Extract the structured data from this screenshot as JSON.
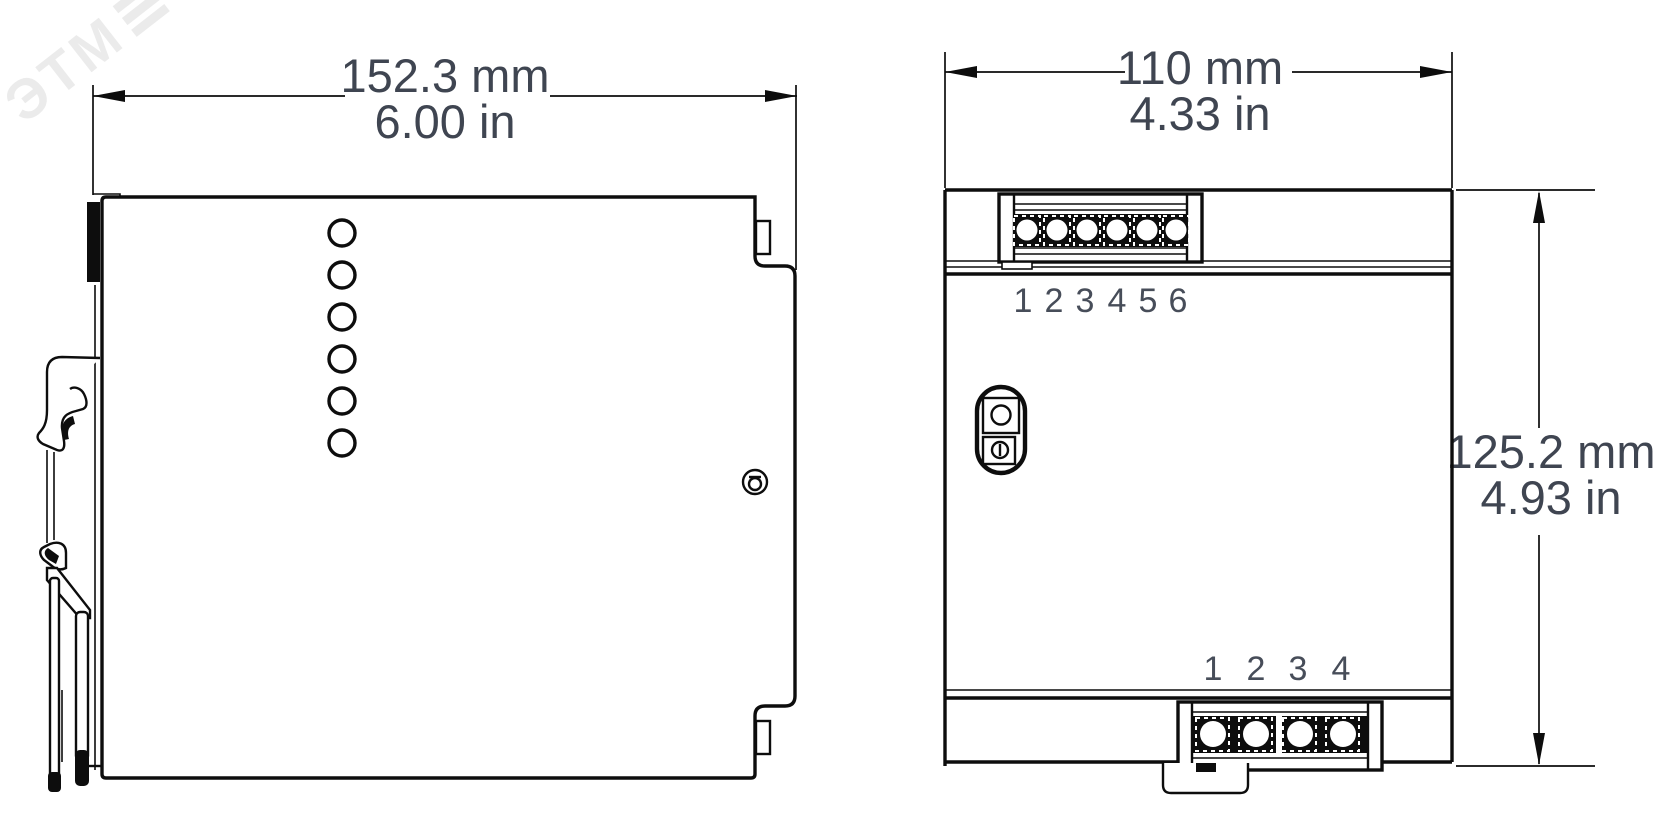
{
  "watermark": {
    "text": "ЭТМ"
  },
  "left_view": {
    "title": "side-view-technical-drawing",
    "width_dimension": {
      "mm": "152.3 mm",
      "in": "6.00 in"
    },
    "vent_hole_count": 6
  },
  "right_view": {
    "title": "front-view-technical-drawing",
    "width_dimension": {
      "mm": "110 mm",
      "in": "4.33 in"
    },
    "height_dimension": {
      "mm": "125.2 mm",
      "in": "4.93 in"
    },
    "top_terminal_labels": [
      "1",
      "2",
      "3",
      "4",
      "5",
      "6"
    ],
    "bottom_terminal_labels": [
      "1",
      "2",
      "3",
      "4"
    ]
  },
  "colors": {
    "line": "#0d0d0d",
    "label": "#3f4551",
    "watermark": "#ebebeb",
    "background": "#ffffff"
  }
}
